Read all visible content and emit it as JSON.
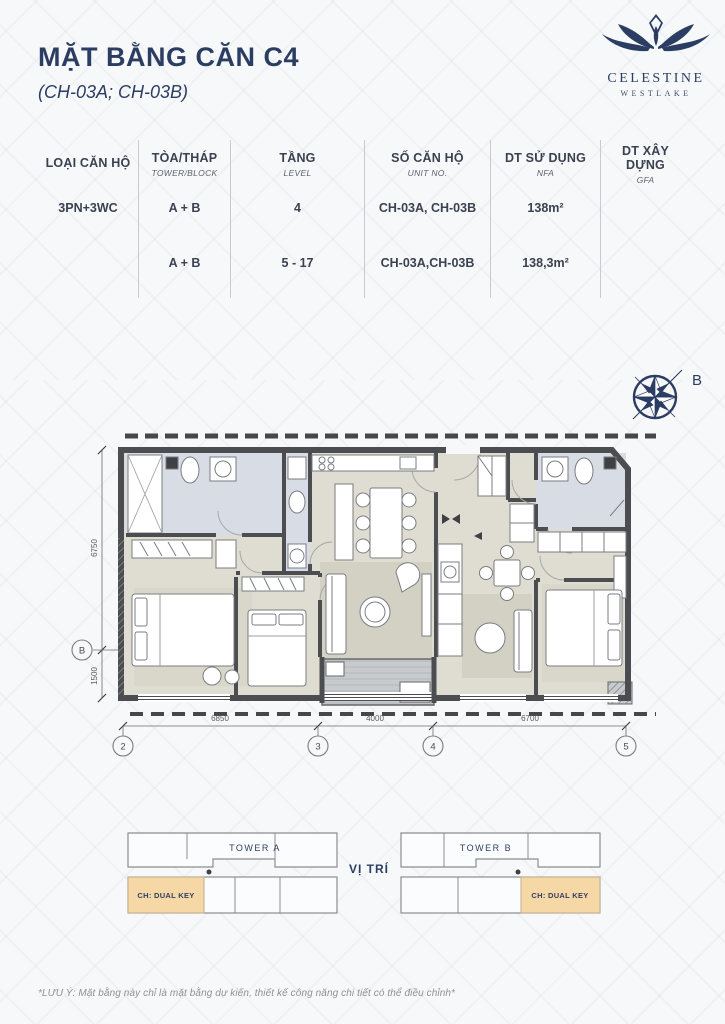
{
  "header": {
    "title": "MẶT BẰNG CĂN C4",
    "subtitle": "(CH-03A; CH-03B)"
  },
  "logo": {
    "brand": "CELESTINE",
    "sub": "WESTLAKE"
  },
  "spec_table": {
    "columns": [
      {
        "vi": "LOẠI CĂN HỘ",
        "en": ""
      },
      {
        "vi": "TÒA/THÁP",
        "en": "TOWER/BLOCK"
      },
      {
        "vi": "TẦNG",
        "en": "LEVEL"
      },
      {
        "vi": "SỐ CĂN HỘ",
        "en": "UNIT NO."
      },
      {
        "vi": "DT SỬ DỤNG",
        "en": "NFA"
      },
      {
        "vi": "DT XÂY DỰNG",
        "en": "GFA"
      }
    ],
    "rows": [
      [
        "3PN+3WC",
        "A + B",
        "4",
        "CH-03A, CH-03B",
        "138m²",
        ""
      ],
      [
        "",
        "A + B",
        "5 - 17",
        "CH-03A,CH-03B",
        "138,3m²",
        ""
      ]
    ]
  },
  "compass": {
    "label": "B"
  },
  "floor_plan": {
    "dims": {
      "left_upper": "6750",
      "left_lower": "1500",
      "bottom": [
        "6850",
        "4000",
        "6700"
      ]
    },
    "grid": {
      "left": "B",
      "bottom": [
        "2",
        "3",
        "4",
        "5"
      ]
    }
  },
  "location": {
    "tower_a": {
      "name": "TOWER A",
      "unit": "CH: DUAL KEY"
    },
    "tower_b": {
      "name": "TOWER B",
      "unit": "CH: DUAL KEY"
    },
    "label": "VỊ TRÍ"
  },
  "footer": {
    "note": "*LƯU Ý: Mặt bằng này chỉ là mặt bằng dự kiến, thiết kế công năng chi tiết có thể điều chỉnh*"
  },
  "colors": {
    "navy": "#2c3d63",
    "wall": "#4b4d50",
    "floor": "#dfddd1",
    "bathroom": "#d8dce5",
    "balcony": "#c8cbcd",
    "highlight_unit": "#f6d7a6"
  }
}
